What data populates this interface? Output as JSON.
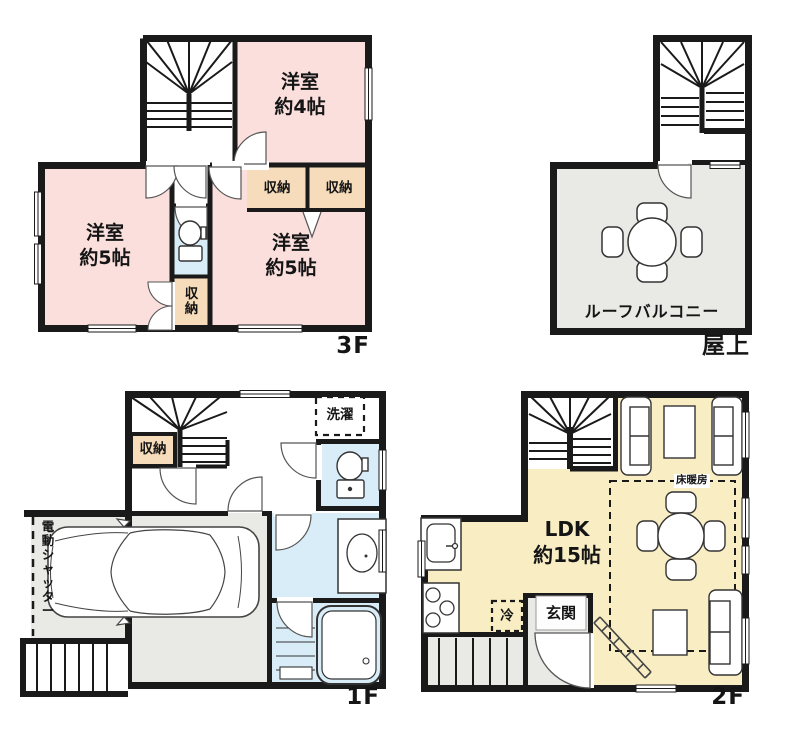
{
  "colors": {
    "wall": "#1a1a1a",
    "western_room_pink": "#fadfdd",
    "closet_tan": "#f6dcba",
    "wet_area_blue": "#d9edf8",
    "ldk_yellow": "#f8edc3",
    "outdoor_gray": "#e9e9e6"
  },
  "floor3": {
    "floor_label": "3F",
    "bedroom4_line1": "洋室",
    "bedroom4_line2": "約4帖",
    "bedroom5a_line1": "洋室",
    "bedroom5a_line2": "約5帖",
    "bedroom5b_line1": "洋室",
    "bedroom5b_line2": "約5帖",
    "closet_a": "収納",
    "closet_b": "収納",
    "closet_c": "収納"
  },
  "roof": {
    "floor_label": "屋上",
    "balcony_label": "ルーフバルコニー"
  },
  "floor1": {
    "floor_label": "1F",
    "closet": "収納",
    "laundry": "洗濯",
    "shutter": "電動シャッター"
  },
  "floor2": {
    "floor_label": "2F",
    "ldk_line1": "LDK",
    "ldk_line2": "約15帖",
    "entrance": "玄関",
    "fridge": "冷",
    "floor_heating": "床暖房"
  }
}
